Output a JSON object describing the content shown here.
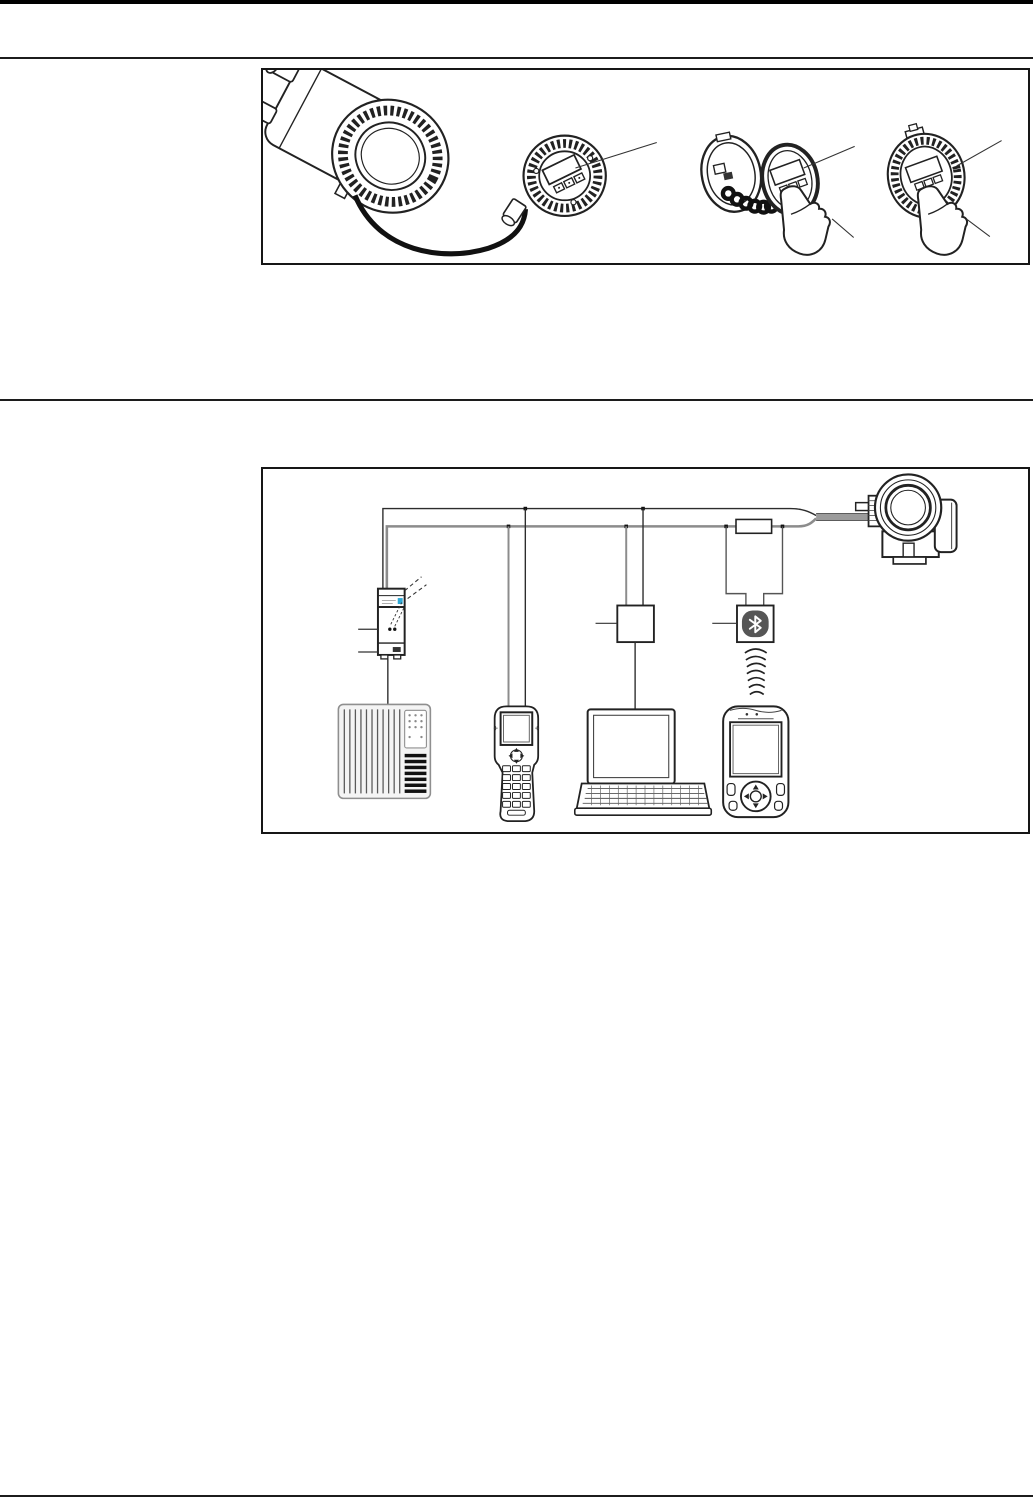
{
  "page": {
    "width": 1033,
    "height": 1506,
    "background": "#ffffff",
    "header_bar_color": "#000000",
    "rule_color": "#1c1c1c"
  },
  "colors": {
    "line": "#222222",
    "wire_black": "#2d2d2d",
    "wire_gray": "#8c8c8c",
    "cable_gray": "#9b9b9b",
    "coil_black": "#111111",
    "bluetooth_badge": "#565656",
    "bluetooth_rune": "#ffffff",
    "plc_fill": "#f4f4f4",
    "plc_stroke": "#8f8f8f",
    "bar_black": "#111111",
    "label_accent_blue": "#2fa8d5"
  },
  "figure_display_module": {
    "name": "display-and-operating-module-options",
    "border_color": "#161616",
    "elements": [
      "transmitter-housing-with-cable-glands",
      "remote-display-module-with-cable",
      "display-module-with-coiled-cable-and-pointing-hand",
      "display-module-mounted-in-cover-with-pointing-hand"
    ],
    "callout_leader_lines": 6
  },
  "figure_remote_operation": {
    "name": "remote-operation-architecture",
    "border_color": "#161616",
    "bus_lines": 2,
    "junction_dots": 6,
    "elements": [
      "plc-controller",
      "power-supply-unit-with-communication-resistor",
      "field-communicator-handheld",
      "interface-modem-box",
      "laptop-computer",
      "bluetooth-modem",
      "wireless-signal-waves",
      "field-xpert-handheld",
      "inline-load-resistor",
      "radar-transmitter"
    ]
  }
}
